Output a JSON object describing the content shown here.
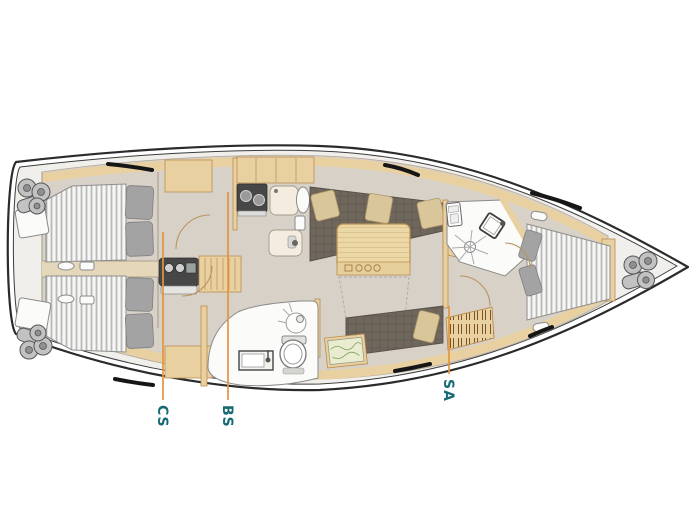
{
  "plan": {
    "callouts": [
      {
        "id": "cs",
        "text": "CS"
      },
      {
        "id": "bs",
        "text": "BS"
      },
      {
        "id": "sa",
        "text": "SA"
      }
    ],
    "colors": {
      "callout_line": "#e2953f",
      "callout_text": "#176a74",
      "hull": "#2b2b2b",
      "deck": "#f0efec",
      "floor": "#d8d1c8",
      "wood": "#e8d0a0",
      "wood_dark": "#b98c50",
      "upholstery": "#6f675c",
      "pillow_beige": "#d9c69a"
    }
  }
}
